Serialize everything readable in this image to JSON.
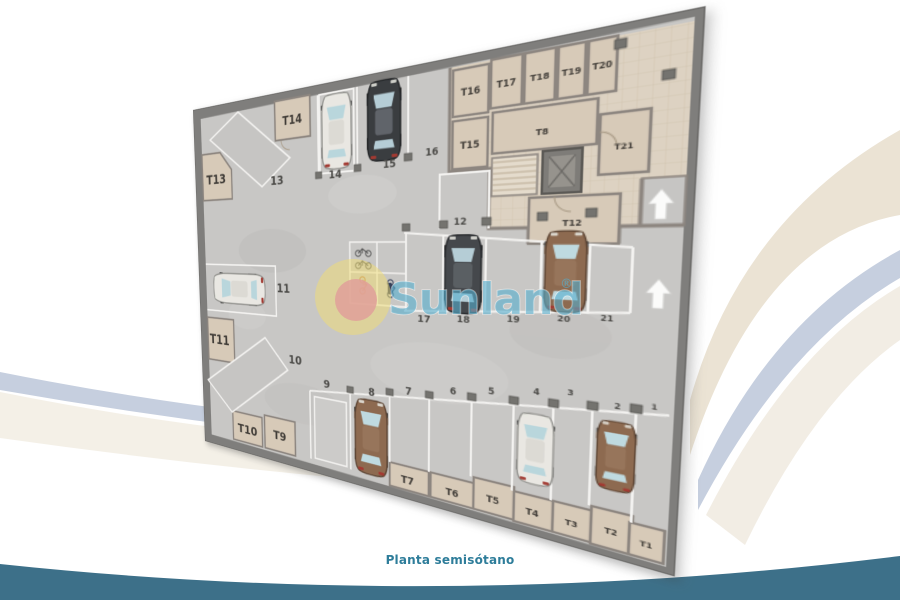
{
  "caption": {
    "text": "Planta semisótano",
    "color": "#2e7d9a"
  },
  "watermark": {
    "brand": "Sunland",
    "registered_mark": "®",
    "text_color": "#55aecd",
    "logo_outer_color": "#f2de72",
    "logo_inner_color": "#e0a09a"
  },
  "background": {
    "band_cream": "#ebe3d4",
    "band_steel": "#c6cfdf",
    "band_teal_bottom": "#3d7089"
  },
  "plan": {
    "floor_color": "#c8c7c5",
    "wall_color": "#7f7e7c",
    "storage_floor_color": "#ddd2c2",
    "storage_room_color": "#d7cab8",
    "storage_labels": [
      "T1",
      "T2",
      "T3",
      "T4",
      "T5",
      "T6",
      "T7",
      "T8",
      "T9",
      "T10",
      "T11",
      "T12",
      "T13",
      "T14",
      "T15",
      "T16",
      "T17",
      "T18",
      "T19",
      "T20",
      "T21"
    ],
    "parking_labels": [
      "1",
      "2",
      "3",
      "4",
      "5",
      "6",
      "7",
      "8",
      "9",
      "10",
      "11",
      "12",
      "13",
      "14",
      "15",
      "16",
      "17",
      "18",
      "19",
      "20",
      "21"
    ],
    "cars": [
      {
        "spot": "2",
        "color": "brown"
      },
      {
        "spot": "4",
        "color": "white"
      },
      {
        "spot": "8",
        "color": "brown"
      },
      {
        "spot": "11",
        "color": "white"
      },
      {
        "spot": "14",
        "color": "white"
      },
      {
        "spot": "15",
        "color": "dark-gray"
      },
      {
        "spot": "18",
        "color": "dark-gray"
      },
      {
        "spot": "20",
        "color": "brown"
      }
    ],
    "ramp_arrow_count": 2
  }
}
